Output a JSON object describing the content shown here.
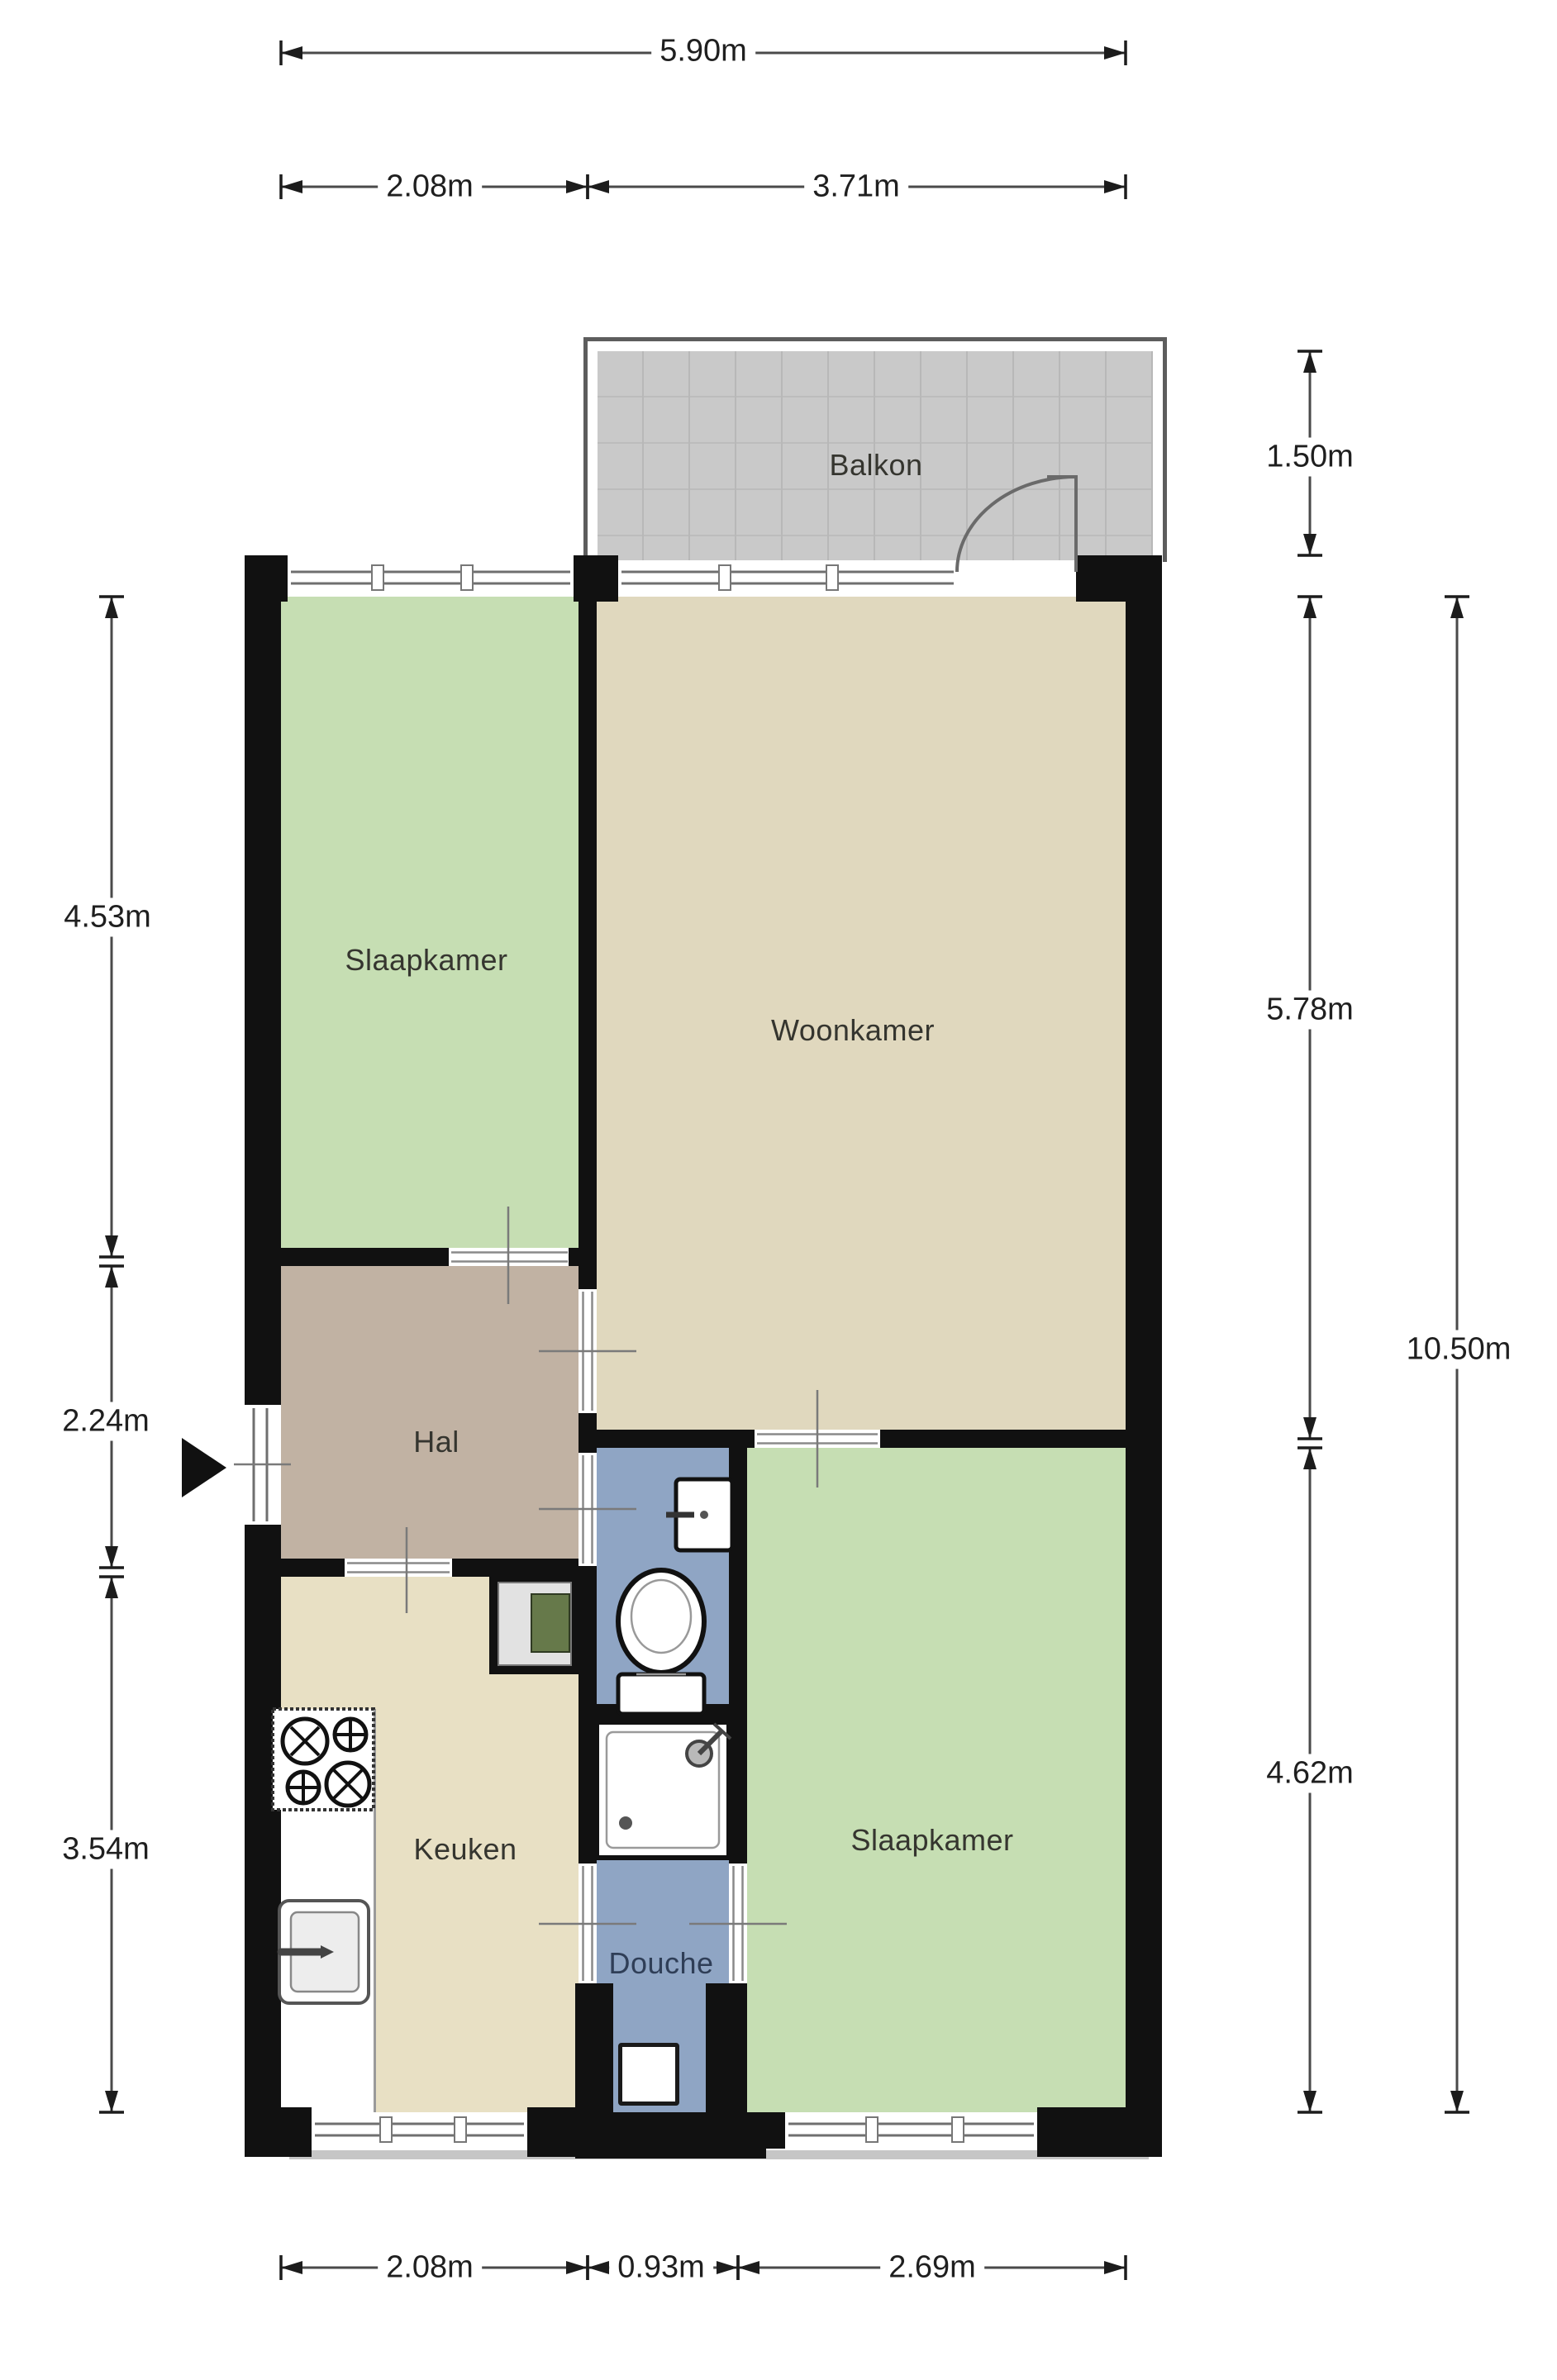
{
  "rooms": {
    "balcony": "Balkon",
    "bedroom_top": "Slaapkamer",
    "living": "Woonkamer",
    "hall": "Hal",
    "kitchen": "Keuken",
    "shower": "Douche",
    "bedroom_bottom": "Slaapkamer"
  },
  "dimensions": {
    "top_total": "5.90m",
    "top_left": "2.08m",
    "top_right": "3.71m",
    "balcony_height": "1.50m",
    "right_upper": "5.78m",
    "right_total": "10.50m",
    "right_lower": "4.62m",
    "left_upper": "4.53m",
    "left_middle": "2.24m",
    "left_lower": "3.54m",
    "bottom_left": "2.08m",
    "bottom_middle": "0.93m",
    "bottom_right": "2.69m"
  },
  "colors": {
    "wall": "#111111",
    "bedroom": "#c6deb3",
    "living": "#e0d8be",
    "kitchen": "#e8e0c4",
    "hall": "#c1b2a3",
    "bath": "#8fa5c4",
    "balcony_tile": "#c9c9c9"
  }
}
